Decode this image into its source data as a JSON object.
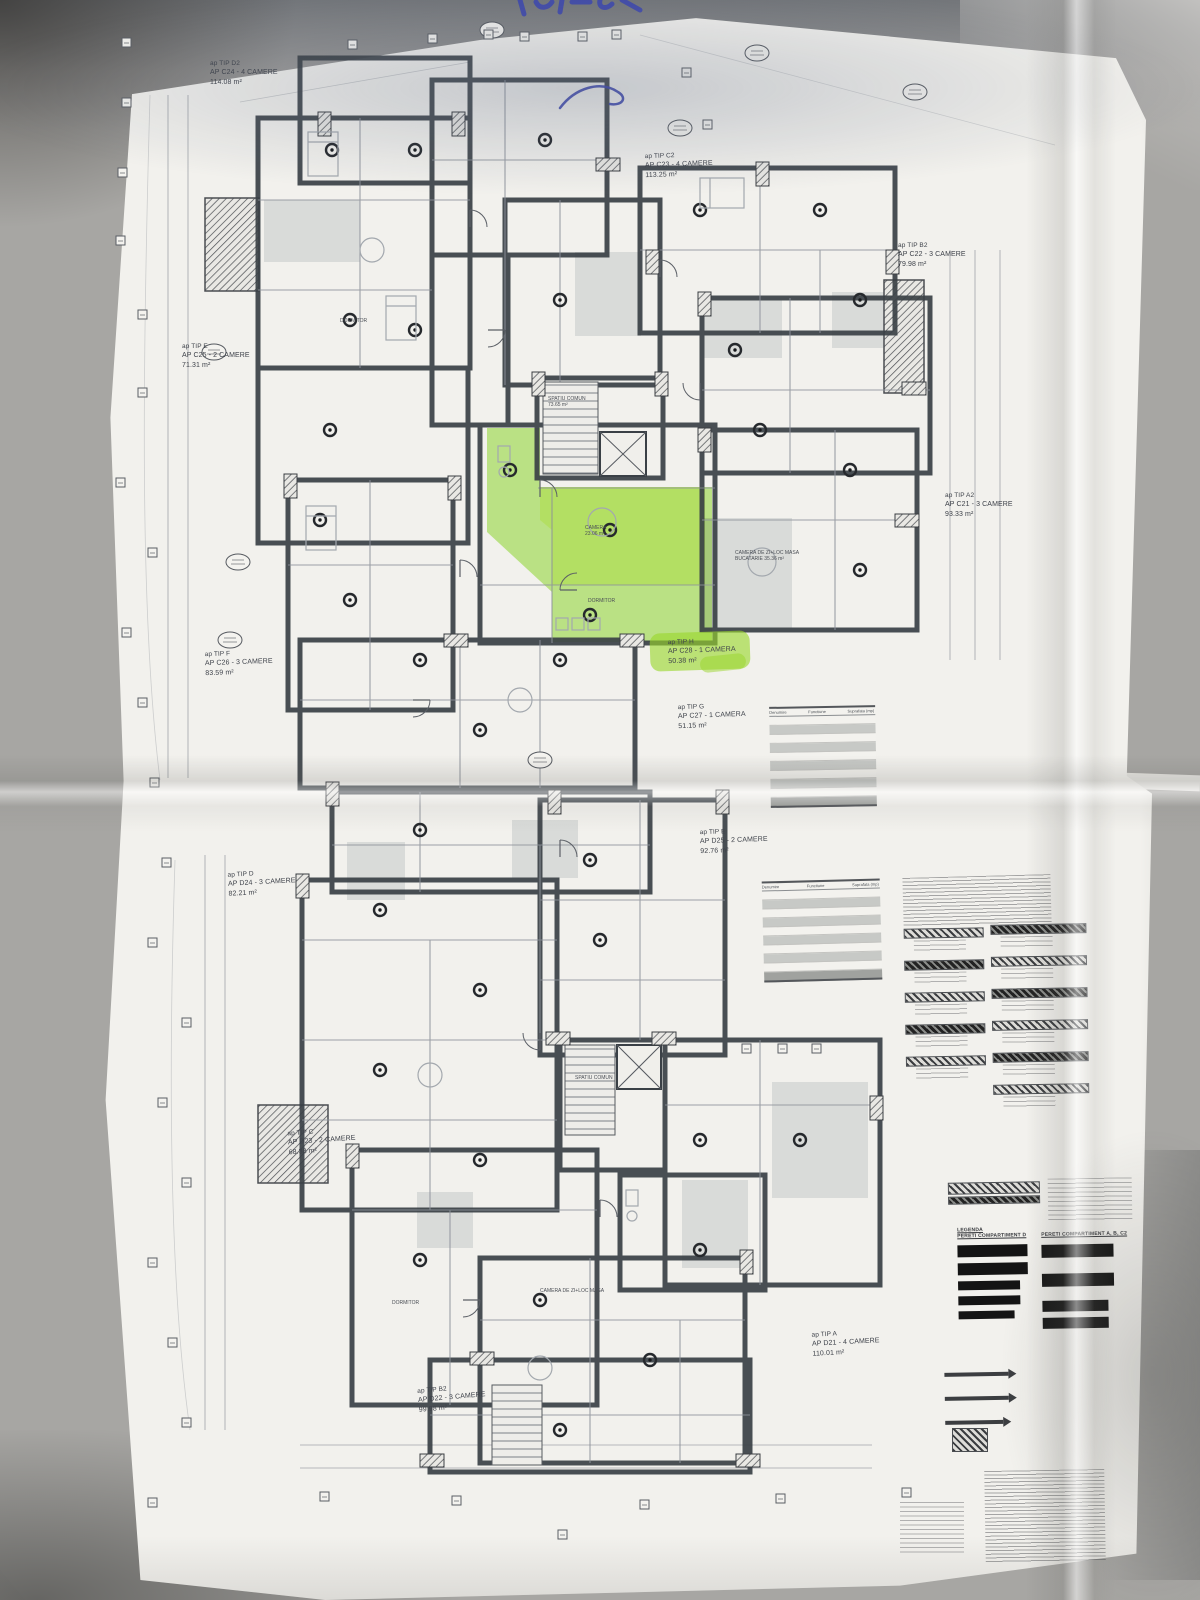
{
  "plan": {
    "highlight_color": "#8dd32e",
    "upper_level": {
      "apartments": [
        {
          "tip": "ap TIP D2",
          "unit": "AP C24 - 4 CAMERE",
          "area": "114.08 m²"
        },
        {
          "tip": "ap TIP C2",
          "unit": "AP C23 - 4 CAMERE",
          "area": "113.25 m²"
        },
        {
          "tip": "ap TIP B2",
          "unit": "AP C22 - 3 CAMERE",
          "area": "79.98 m²"
        },
        {
          "tip": "ap TIP E",
          "unit": "AP C25 - 2 CAMERE",
          "area": "71.31 m²"
        },
        {
          "tip": "ap TIP A2",
          "unit": "AP C21 - 3 CAMERE",
          "area": "93.33 m²"
        },
        {
          "tip": "ap TIP F",
          "unit": "AP C26 - 3 CAMERE",
          "area": "83.59 m²"
        },
        {
          "tip": "ap TIP H",
          "unit": "AP C28 - 1 CAMERA",
          "area": "50.38 m²",
          "highlighted": true
        },
        {
          "tip": "ap TIP G",
          "unit": "AP C27 - 1 CAMERA",
          "area": "51.15 m²"
        }
      ]
    },
    "lower_level": {
      "apartments": [
        {
          "tip": "ap TIP E",
          "unit": "AP D25 - 2 CAMERE",
          "area": "92.76 m²"
        },
        {
          "tip": "ap TIP D",
          "unit": "AP D24 - 3 CAMERE",
          "area": "82.21 m²"
        },
        {
          "tip": "ap TIP C",
          "unit": "AP D23 - 2 CAMERE",
          "area": "68.38 m²"
        },
        {
          "tip": "ap TIP B2",
          "unit": "AP D22 - 3 CAMERE",
          "area": "99.98 m²"
        },
        {
          "tip": "ap TIP A",
          "unit": "AP D21 - 4 CAMERE",
          "area": "110.01 m²"
        }
      ]
    },
    "common_areas": {
      "upper": {
        "l1": "SPATIU COMUN",
        "l2": "73.65 m²"
      },
      "lower": {
        "l1": "SPATIU COMUN"
      }
    },
    "room_labels": {
      "a": {
        "l1": "CAMERA",
        "l2": "23.06 m²"
      },
      "b": {
        "l1": "DORMITOR"
      },
      "c": {
        "l1": "CAMERA DE ZI+LOC MASA",
        "l2": "BUCATARIE  35.36 m²"
      },
      "d": {
        "l1": "CAMERA DE ZI+LOC MASA"
      },
      "e": {
        "l1": "DORMITOR"
      },
      "f": {
        "l1": "DORMITOR"
      }
    }
  },
  "tables": {
    "columns": {
      "c1": "Denumire",
      "c2": "Functiune",
      "c3": "Suprafata (mp)"
    }
  },
  "legend": {
    "title": "LEGENDA",
    "left_heading": "PERETI COMPARTIMENT D",
    "right_heading": "PERETI COMPARTIMENT A, B, C2"
  }
}
